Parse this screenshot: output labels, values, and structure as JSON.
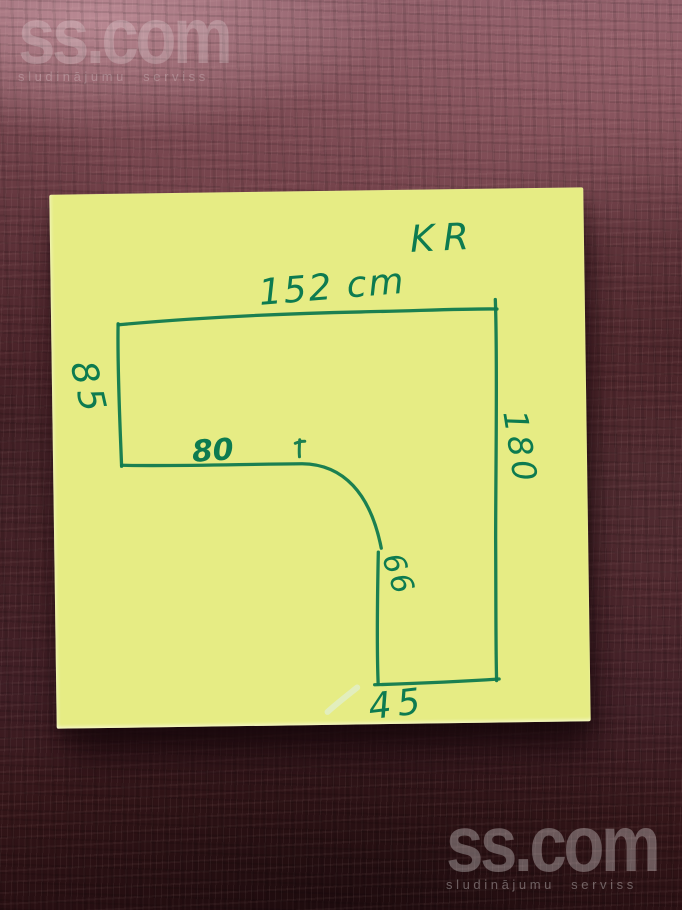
{
  "watermark": {
    "logo": "ss.com",
    "tagline": "sludinājumu serviss"
  },
  "note": {
    "corner_label": "KR",
    "dimensions": {
      "top_width": "152 cm",
      "left_height": "85",
      "right_height": "180",
      "inner_width": "80",
      "inner_height": "66",
      "bottom_width": "45"
    }
  },
  "colors": {
    "marker_green": "#0e7b50",
    "note_paper": "#e6ec84",
    "wood_background": "#5d3036",
    "watermark_white": "#ffffff"
  }
}
